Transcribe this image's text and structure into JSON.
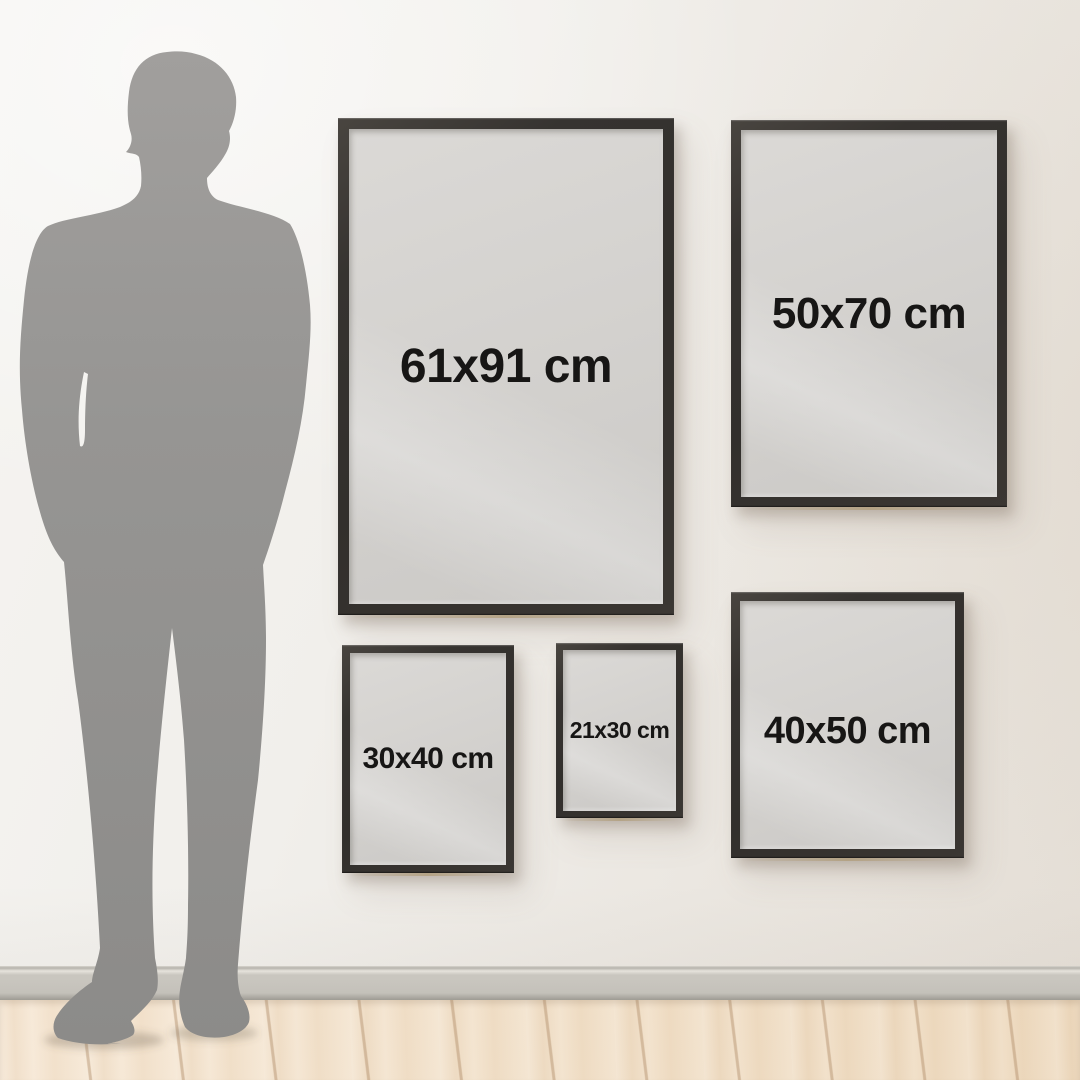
{
  "frames": [
    {
      "id": "61x91",
      "label": "61x91 cm",
      "width_cm": 61,
      "height_cm": 91
    },
    {
      "id": "50x70",
      "label": "50x70 cm",
      "width_cm": 50,
      "height_cm": 70
    },
    {
      "id": "30x40",
      "label": "30x40 cm",
      "width_cm": 30,
      "height_cm": 40
    },
    {
      "id": "21x30",
      "label": "21x30 cm",
      "width_cm": 21,
      "height_cm": 30
    },
    {
      "id": "40x50",
      "label": "40x50 cm",
      "width_cm": 40,
      "height_cm": 50
    }
  ],
  "silhouette": {
    "name": "standing-man-silhouette"
  },
  "colors": {
    "frame": "#322f2c",
    "poster": "#d4d2cf",
    "label_text": "#171615",
    "wall_light": "#f5f4f1",
    "wall_shade": "#e5dfd7",
    "baseboard": "#c9c6bf",
    "floor_wood": "#f2e1ca",
    "silhouette_gray": "#969593"
  }
}
